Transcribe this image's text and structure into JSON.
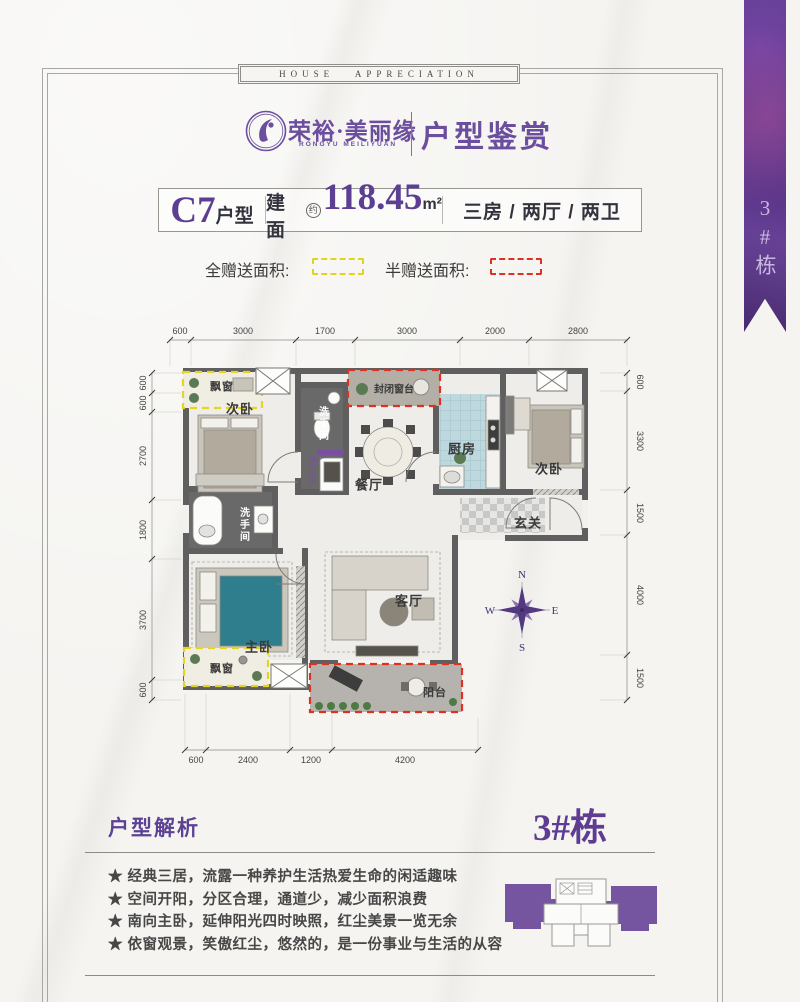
{
  "banner": {
    "text": "HOUSE APPRECIATION"
  },
  "brand": {
    "name": "荣裕·美丽缘",
    "name_en": "RONGYU MEILIYUAN",
    "section": "户型鉴赏"
  },
  "unit": {
    "code": "C7",
    "code_suffix": "户型",
    "area_label": "建面",
    "area_approx": "约",
    "area_value": "118.45",
    "area_unit": "m²",
    "layout": "三房 / 两厅 / 两卫"
  },
  "legend": {
    "full": "全赠送面积:",
    "half": "半赠送面积:"
  },
  "ribbon": {
    "label": "3#栋"
  },
  "plan": {
    "rooms": {
      "bay_top": "飘窗",
      "bedroom_left": "次卧",
      "bath_top": "洗手间",
      "closed_sill": "封闭窗台",
      "dining": "餐厅",
      "kitchen": "厨房",
      "bedroom_right": "次卧",
      "foyer": "玄关",
      "bath_mid": "洗手间",
      "master": "主卧",
      "bay_bottom": "飘窗",
      "living": "客厅",
      "balcony": "阳台",
      "note": "用户自理"
    },
    "compass": {
      "n": "N",
      "e": "E",
      "s": "S",
      "w": "W"
    },
    "dims": {
      "top": [
        "600",
        "3000",
        "1700",
        "3000",
        "2000",
        "2800"
      ],
      "left": [
        "600",
        "600",
        "2700",
        "1800",
        "3700",
        "600"
      ],
      "right": [
        "600",
        "3300",
        "1500",
        "4000",
        "1500"
      ],
      "bottom": [
        "600",
        "2400",
        "1200",
        "4200"
      ]
    }
  },
  "analysis": {
    "heading": "户型解析",
    "building": "3#栋",
    "bullets": [
      "★ 经典三居，流露一种养护生活热爱生命的闲适趣味",
      "★ 空间开阳，分区合理，通道少，减少面积浪费",
      "★ 南向主卧，延伸阳光四时映照，红尘美景一览无余",
      "★ 依窗观景，笑傲红尘，悠然的，是一份事业与生活的从容"
    ]
  },
  "colors": {
    "accent": "#5f3d91",
    "gift_full": "#ded51e",
    "gift_half": "#e03022",
    "wall": "#5f5f5f"
  }
}
